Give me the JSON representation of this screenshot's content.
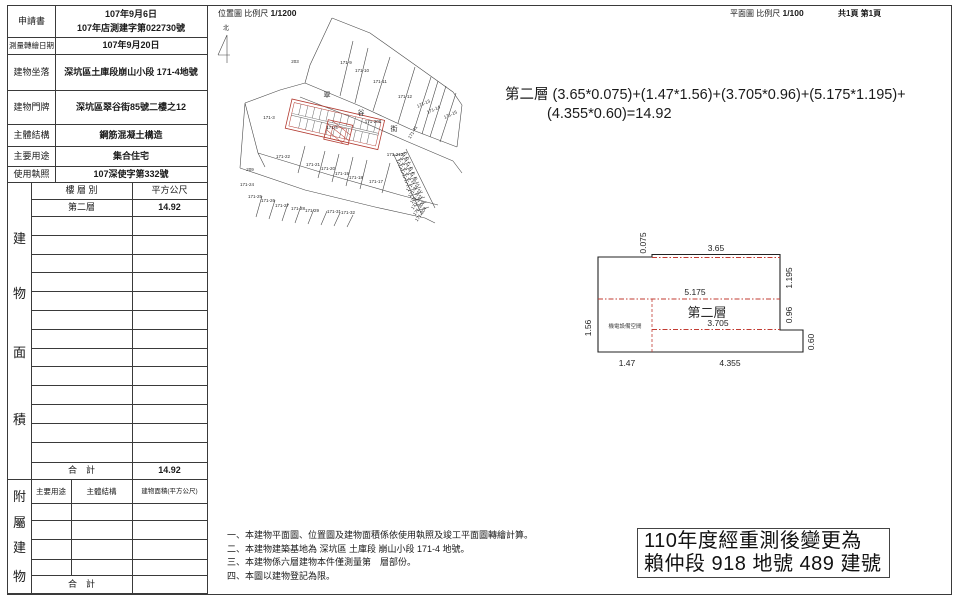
{
  "headers": {
    "location_title": "位置圖",
    "scale_label": "比例尺",
    "location_scale": "1/1200",
    "plan_title": "平面圖",
    "plan_scale": "1/100",
    "page_count": "共1頁 第1頁"
  },
  "info_table": {
    "rows": [
      {
        "label": "申請書",
        "value": "107年9月6日",
        "value2": "107年店測建字第022730號"
      },
      {
        "label": "測量轉繪日期",
        "value": "107年9月20日"
      },
      {
        "label": "建物坐落",
        "value": "深坑區土庫段崩山小段 171-4地號"
      },
      {
        "label": "建物門牌",
        "value": "深坑區翠谷街85號二樓之12"
      },
      {
        "label": "主體結構",
        "value": "鋼筋混凝土構造"
      },
      {
        "label": "主要用途",
        "value": "集合住宅"
      },
      {
        "label": "使用執照",
        "value": "107深使字第332號"
      }
    ]
  },
  "area_table": {
    "side_label": "建物面積",
    "col_floor": "樓 層 別",
    "col_area": "平方公尺",
    "floor": "第二層",
    "area": "14.92",
    "total_label": "合　計",
    "total": "14.92"
  },
  "annex_table": {
    "side_label": "附屬建物",
    "col_use": "主要用途",
    "col_structure": "主體結構",
    "col_area": "建物面積(平方公尺)",
    "total_label": "合　計"
  },
  "formula": {
    "line1": "第二層 (3.65*0.075)+(1.47*1.56)+(3.705*0.96)+(5.175*1.195)+",
    "line2": "(4.355*0.60)=14.92"
  },
  "floor_plan": {
    "room_label": "第二層",
    "mech_label": "機電設備空間",
    "dims": {
      "top_sliver": "0.075",
      "top": "3.65",
      "right_upper": "1.195",
      "mid": "5.175",
      "right_mid": "0.96",
      "inner": "3.705",
      "left": "1.56",
      "right_low": "0.60",
      "bottom_left": "1.47",
      "bottom_right": "4.355"
    }
  },
  "map": {
    "north_label": "北",
    "street_name": "翠谷街",
    "street_chars": [
      {
        "t": "翠",
        "x": 117,
        "y": 92
      },
      {
        "t": "谷",
        "x": 151,
        "y": 110
      },
      {
        "t": "街",
        "x": 184,
        "y": 126
      }
    ],
    "parcels": [
      {
        "t": "203",
        "x": 85,
        "y": 58
      },
      {
        "t": "171-9",
        "x": 136,
        "y": 59
      },
      {
        "t": "171-10",
        "x": 152,
        "y": 67
      },
      {
        "t": "171-11",
        "x": 170,
        "y": 78
      },
      {
        "t": "171-12",
        "x": 195,
        "y": 93
      },
      {
        "t": "171-13",
        "x": 214,
        "y": 100,
        "r": -24
      },
      {
        "t": "171-14",
        "x": 224,
        "y": 106,
        "r": -24
      },
      {
        "t": "171-15",
        "x": 241,
        "y": 111,
        "r": -24
      },
      {
        "t": "171-3",
        "x": 59,
        "y": 114
      },
      {
        "t": "171-208",
        "x": 163,
        "y": 118
      },
      {
        "t": "171-4",
        "x": 122,
        "y": 124
      },
      {
        "t": "171-41",
        "x": 204,
        "y": 128,
        "r": -60
      },
      {
        "t": "171-212",
        "x": 185,
        "y": 151
      },
      {
        "t": "171-22",
        "x": 73,
        "y": 153
      },
      {
        "t": "171-21",
        "x": 103,
        "y": 161
      },
      {
        "t": "171-20",
        "x": 118,
        "y": 165
      },
      {
        "t": "171-19",
        "x": 132,
        "y": 170
      },
      {
        "t": "171-18",
        "x": 146,
        "y": 174
      },
      {
        "t": "171-17",
        "x": 166,
        "y": 178
      },
      {
        "t": "209",
        "x": 40,
        "y": 166
      },
      {
        "t": "171-24",
        "x": 37,
        "y": 181
      },
      {
        "t": "171-25",
        "x": 45,
        "y": 193
      },
      {
        "t": "171-26",
        "x": 58,
        "y": 197
      },
      {
        "t": "171-27",
        "x": 72,
        "y": 202
      },
      {
        "t": "171-28",
        "x": 88,
        "y": 205
      },
      {
        "t": "171-29",
        "x": 102,
        "y": 207
      },
      {
        "t": "171-31",
        "x": 124,
        "y": 208
      },
      {
        "t": "171-32",
        "x": 138,
        "y": 209
      },
      {
        "t": "171-45",
        "x": 193,
        "y": 154,
        "r": -55
      },
      {
        "t": "171-46",
        "x": 195,
        "y": 159,
        "r": -55
      },
      {
        "t": "171-47",
        "x": 197,
        "y": 164,
        "r": -55
      },
      {
        "t": "171-48",
        "x": 199,
        "y": 169,
        "r": -55
      },
      {
        "t": "171-49",
        "x": 201,
        "y": 174,
        "r": -55
      },
      {
        "t": "171-298",
        "x": 203,
        "y": 180,
        "r": -55
      },
      {
        "t": "171-341",
        "x": 205,
        "y": 186,
        "r": -55
      },
      {
        "t": "171-342",
        "x": 207,
        "y": 192,
        "r": -55
      },
      {
        "t": "171-302",
        "x": 208,
        "y": 198,
        "r": -55
      },
      {
        "t": "171-303",
        "x": 210,
        "y": 204,
        "r": -55
      },
      {
        "t": "171-304",
        "x": 212,
        "y": 210,
        "r": -55
      }
    ],
    "highlight_color": "#b2392f"
  },
  "notes": [
    "一、本建物平面圖、位置圖及建物面積係依使用執照及竣工平面圖轉繪計算。",
    "二、本建物建築基地為 深坑區 土庫段 崩山小段 171-4 地號。",
    "三、本建物係六層建物本件僅測量第　層部份。",
    "四、本圖以建物登記為限。"
  ],
  "stamp_box": {
    "line1": "110年度經重測後變更為",
    "line2": "賴仲段 918 地號 489 建號"
  }
}
